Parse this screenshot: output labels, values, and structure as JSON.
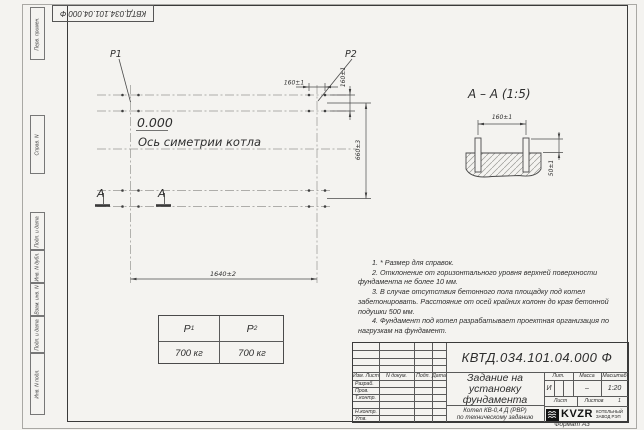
{
  "sheet": {
    "top_designation": "КВТД.034.101.04.000 Ф",
    "format_label": "Формат А3"
  },
  "margin_labels": {
    "perv_primen": "Перв. примен.",
    "sprav_n": "Справ. N",
    "podp_data_1": "Подп. и дата",
    "inv_dubl": "Инв. N дубл.",
    "vzam_inv": "Взам. инв. N",
    "podp_data_2": "Подп. и дата",
    "inv_podl": "Инв. N подл."
  },
  "plan": {
    "p1_label": "P1",
    "p2_label": "P2",
    "elevation": "0.000",
    "axis_label": "Ось симетрии котла",
    "dim_160_top": "160±1",
    "dim_160_right": "160±1",
    "dim_660": "660±3",
    "dim_1640": "1640±2",
    "section_letter_left": "А",
    "section_letter_right": "А"
  },
  "section": {
    "title": "А – А (1:5)",
    "dim_160": "160±1",
    "dim_50": "50±1"
  },
  "load_table": {
    "col1_header": "P",
    "col1_sub": "1",
    "col2_header": "P",
    "col2_sub": "2",
    "col1_value": "700 кг",
    "col2_value": "700 кг"
  },
  "notes": {
    "line1": "1. * Размер для справок.",
    "line2": "2. Отклонение от горизонтального уровня верхней поверхности фундамента не более 10 мм.",
    "line3": "3. В случае отсутствия бетонного пола площадку под котел забетонировать. Расстояние от осей крайних колонн до края бетонной подушки 500 мм.",
    "line4": "4. Фундамент под котел разрабатывает проектная организация по нагрузкам на фундамент."
  },
  "title_block": {
    "designation": "КВТД.034.101.04.000 Ф",
    "title_line1": "Задание на",
    "title_line2": "установку",
    "title_line3": "фундамента",
    "subtitle_line1": "Котел КВ-0,4 Д (РВР)",
    "subtitle_line2": "по техническому заданию",
    "header_izm": "Изм. Лист",
    "header_docum": "N докум.",
    "header_podp": "Подп.",
    "header_data": "Дата",
    "row_razrab": "Разраб.",
    "row_prov": "Пров.",
    "row_tkontr": "Т.контр.",
    "row_nkontr": "Н.контр.",
    "row_utv": "Утв.",
    "lit_header": "Лит.",
    "massa_header": "Масса",
    "masshtab_header": "Масштаб",
    "lit_value": "И",
    "massa_value": "–",
    "masshtab_value": "1:20",
    "list_label": "Лист",
    "listov_label": "Листов",
    "listov_value": "1",
    "logo_text": "KVZR",
    "logo_caption_line1": "КОТЕЛЬНЫЙ",
    "logo_caption_line2": "ЗАВОД РЭП"
  }
}
